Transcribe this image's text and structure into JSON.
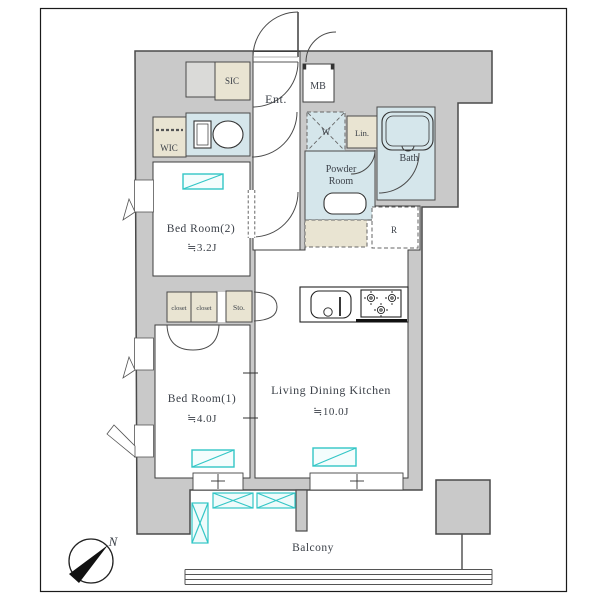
{
  "plan": {
    "labels": {
      "sic": "SIC",
      "ent": "Ent.",
      "mb": "MB",
      "wic": "WIC",
      "washer": "W",
      "lin": "Lin.",
      "powder_line1": "Powder",
      "powder_line2": "Room",
      "bath": "Bath",
      "bedroom2_name": "Bed Room(2)",
      "bedroom2_size": "≒3.2J",
      "closet_a": "closet",
      "closet_b": "closet",
      "storage": "Sto.",
      "fridge": "R",
      "bedroom1_name": "Bed Room(1)",
      "bedroom1_size": "≒4.0J",
      "ldk_name": "Living Dining Kitchen",
      "ldk_size": "≒10.0J",
      "balcony": "Balcony",
      "compass_north": "N"
    },
    "colors": {
      "wall_fill": "#c9c9c9",
      "wall_outline": "#4a4a4a",
      "wet_area": "#d5e6eb",
      "closet_beige": "#e9e4d2",
      "window_accent": "#33c6c6",
      "text": "#3b4048"
    }
  }
}
